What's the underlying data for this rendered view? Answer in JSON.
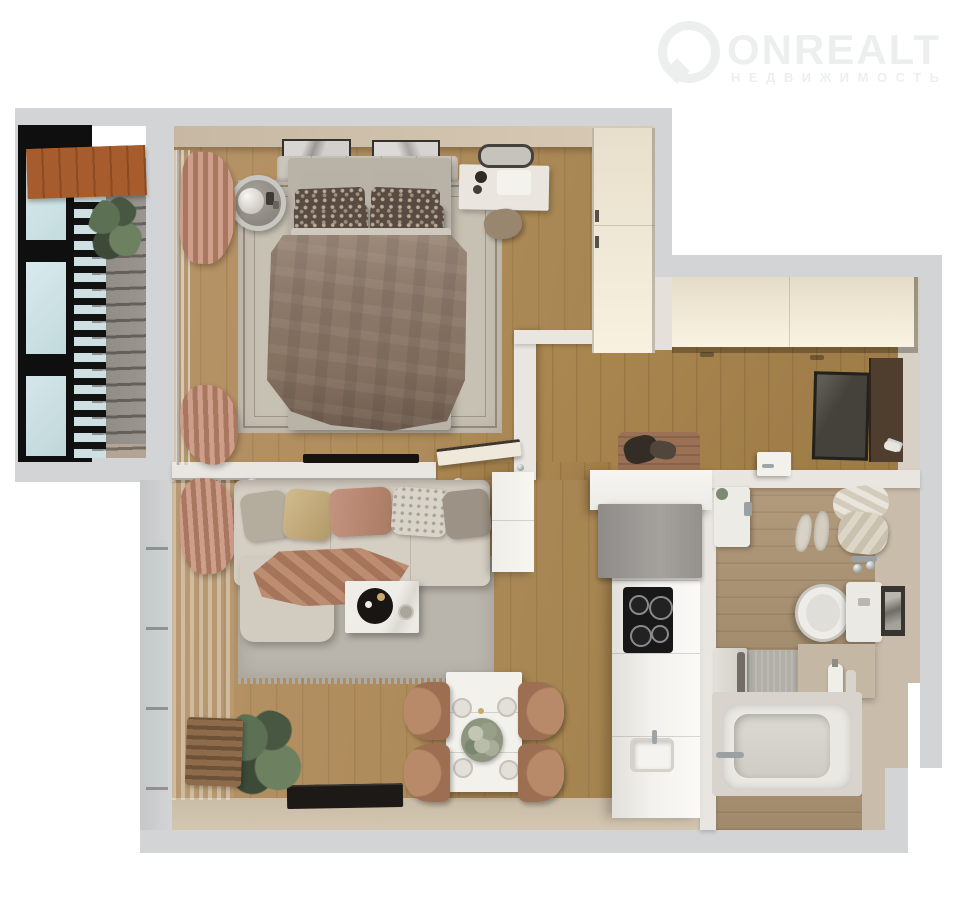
{
  "brand": {
    "name": "ONREALT",
    "tagline": "НЕДВИЖИМОСТЬ",
    "logo_color": "#edefef"
  },
  "palette": {
    "background": "#ffffff",
    "outer_wall_gray": "#d2d4d6",
    "inner_wall_white": "#e9e6e1",
    "wall_face_beige": "#cbbca8",
    "floor_wood_main": "#ae8b5a",
    "floor_wood_hall": "#a07c46",
    "floor_bath_tile": "#a98f70",
    "balcony_concrete": "#94908a",
    "brick": "#a05a2b",
    "window_frame_black": "#0f0f0f",
    "glass_blue": "#cfe3e6",
    "wardrobe_cream": "#f2ead8",
    "kitchen_counter_white": "#f2f1ed",
    "appliance_gray": "#9c9896",
    "cooktop_black": "#181818",
    "sofa_beige": "#d5cec3",
    "rug_gray": "#bab5ac",
    "bedroom_rug": "#c7c1b3",
    "curtain_rose": "#c0876f",
    "duvet_brown": "#8d7a6b",
    "chair_terracotta": "#a87a5f",
    "fixture_white": "#eceae6",
    "mirror_dark": "#45423b",
    "plant_green": "#5c7154"
  },
  "floorplan": {
    "type": "one-bedroom-apartment-top-down-3d-render",
    "rooms": [
      {
        "id": "balcony",
        "features": [
          "black-frame-windows",
          "brick-wall",
          "potted-plant",
          "concrete-floor"
        ]
      },
      {
        "id": "bedroom",
        "features": [
          "double-bed",
          "patterned-pillows",
          "area-rug",
          "round-side-table",
          "vanity-desk",
          "wall-mirror",
          "pouf",
          "wardrobe",
          "curtains",
          "wall-art",
          "wall-tv"
        ]
      },
      {
        "id": "hallway",
        "features": [
          "built-in-closet",
          "leaning-mirror",
          "entry-door-panel",
          "shoe-bench",
          "shoes"
        ]
      },
      {
        "id": "living-room",
        "features": [
          "corner-sofa",
          "throw-pillows",
          "throw-blanket",
          "coffee-table",
          "area-rug",
          "dining-table",
          "dining-chairs",
          "plates",
          "bouquet",
          "wall-tv",
          "plant",
          "slat-bench",
          "curtains",
          "white-cabinet"
        ]
      },
      {
        "id": "kitchen",
        "features": [
          "counter-run",
          "tall-gray-cabinet",
          "induction-cooktop",
          "sink"
        ]
      },
      {
        "id": "bathroom",
        "features": [
          "washbasin",
          "washing-machine",
          "bathtub",
          "toilet",
          "towels",
          "slippers",
          "bath-mat",
          "wall-art",
          "shower-mixer",
          "soap-bottles",
          "door"
        ]
      }
    ]
  }
}
